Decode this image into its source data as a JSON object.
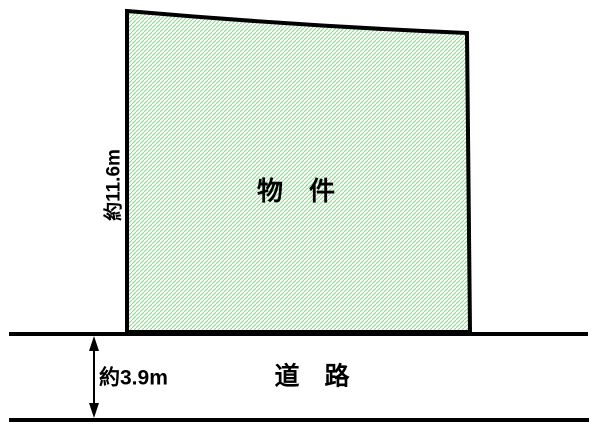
{
  "property": {
    "label": "物　件",
    "depth_label": "約11.6m"
  },
  "road": {
    "label": "道　路",
    "width_label": "約3.9m"
  },
  "colors": {
    "outline": "#000000",
    "hatch": "#74e874",
    "plot_bg": "#fdfffd",
    "canvas_bg": "#ffffff"
  }
}
